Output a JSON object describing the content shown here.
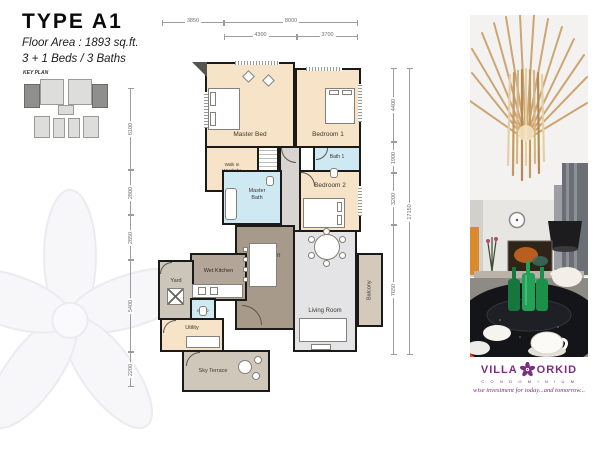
{
  "header": {
    "title": "TYPE A1",
    "floor_area": "Floor Area : 1893 sq.ft.",
    "beds_baths": "3 + 1 Beds / 3 Baths",
    "key_plan_label": "KEY PLAN"
  },
  "floor_plan": {
    "rooms": {
      "master_bed": "Master Bed",
      "bedroom_1": "Bedroom 1",
      "bedroom_2": "Bedroom 2",
      "walk_in_wardrobe": "Walk In Wardrobe",
      "master_bath": "Master Bath",
      "bath_1": "Bath 1",
      "bath_2": "Bath 2",
      "dry_kitchen": "Dry Kitchen",
      "wet_kitchen": "Wet Kitchen",
      "yard": "Yard",
      "utility": "Utility",
      "dining": "Dining",
      "living_room": "Living Room",
      "balcony": "Balcony",
      "sky_terrace": "Sky Terrace"
    },
    "dimensions": {
      "top": [
        "3850",
        "8000",
        "4300",
        "3700"
      ],
      "left": [
        "6100",
        "2800",
        "2850",
        "5400",
        "2200"
      ],
      "right": [
        "4400",
        "1900",
        "3200",
        "7650",
        "17150"
      ]
    }
  },
  "branding": {
    "villa": "VILLA",
    "orkid": "ORKID",
    "condominium": "C O N D O M I N I U M",
    "tagline": "wise investment for today...and tomorrow..."
  },
  "colors": {
    "bedroom_fill": "#f6e3c8",
    "bath_fill": "#cfe9f2",
    "kitchen_fill": "#a89a8a",
    "living_fill": "#e4e4e6",
    "terrace_fill": "#cfc7ba",
    "wall": "#1a1a1a",
    "brand_purple": "#7b2e82"
  }
}
